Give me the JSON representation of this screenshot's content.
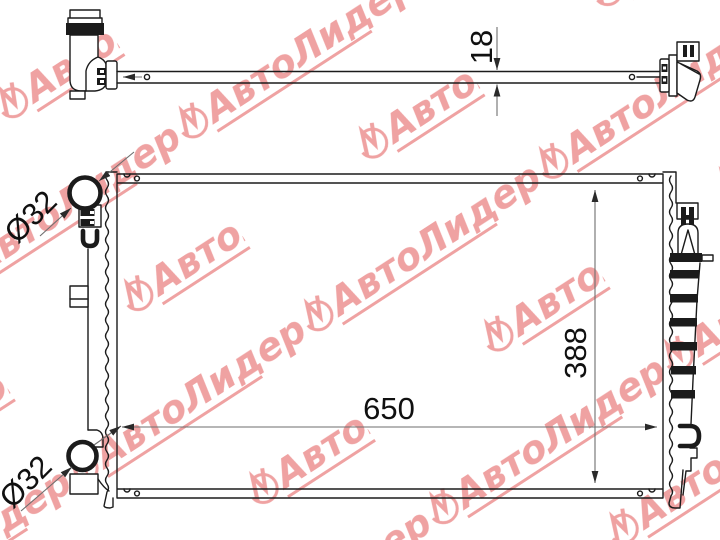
{
  "watermark": {
    "brand": "АвтоЛидер",
    "color": "#efa2a2",
    "logo": "autolider-emblem"
  },
  "colors": {
    "background": "#ffffff",
    "drawing_line": "#1b1b1b",
    "dimension_line": "#6e6e6e",
    "dimension_text": "#101010"
  },
  "views": {
    "top_view": {
      "thickness_label": "18"
    },
    "front_view": {
      "width_label": "650",
      "height_label": "388",
      "inlet_diameter_label": "Ø32",
      "outlet_diameter_label": "Ø32"
    }
  }
}
